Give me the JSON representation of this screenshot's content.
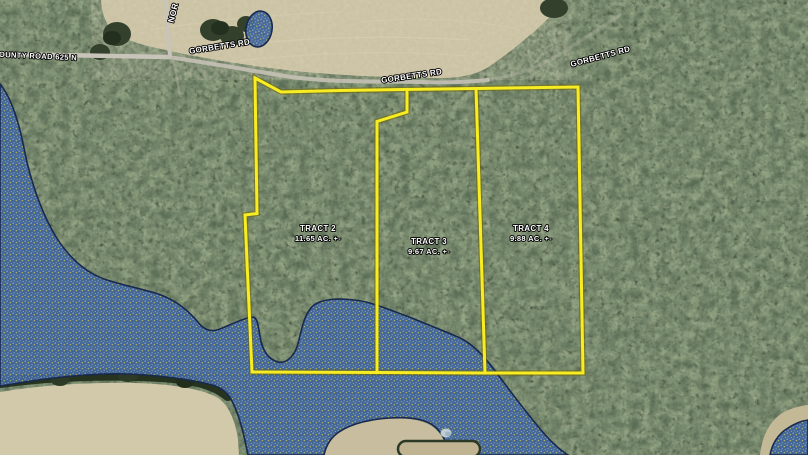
{
  "roads": {
    "county_road_625n": "COUNTY ROAD 625 N",
    "gorbetts_rd_west": "GORBETTS RD",
    "gorbetts_rd_center": "GORBETTS RD",
    "gorbetts_rd_east": "GORBETTS RD",
    "north_road_fragment": "NOR"
  },
  "tracts": [
    {
      "name": "TRACT 2",
      "acreage": "11.65 AC. +-"
    },
    {
      "name": "TRACT 3",
      "acreage": "9.67 AC. +-"
    },
    {
      "name": "TRACT 4",
      "acreage": "9.88 AC. +-"
    }
  ],
  "colors": {
    "tract_boundary": "#f7ed22",
    "flood_zone_fill": "#3f639b",
    "flood_zone_border": "#18294d"
  }
}
